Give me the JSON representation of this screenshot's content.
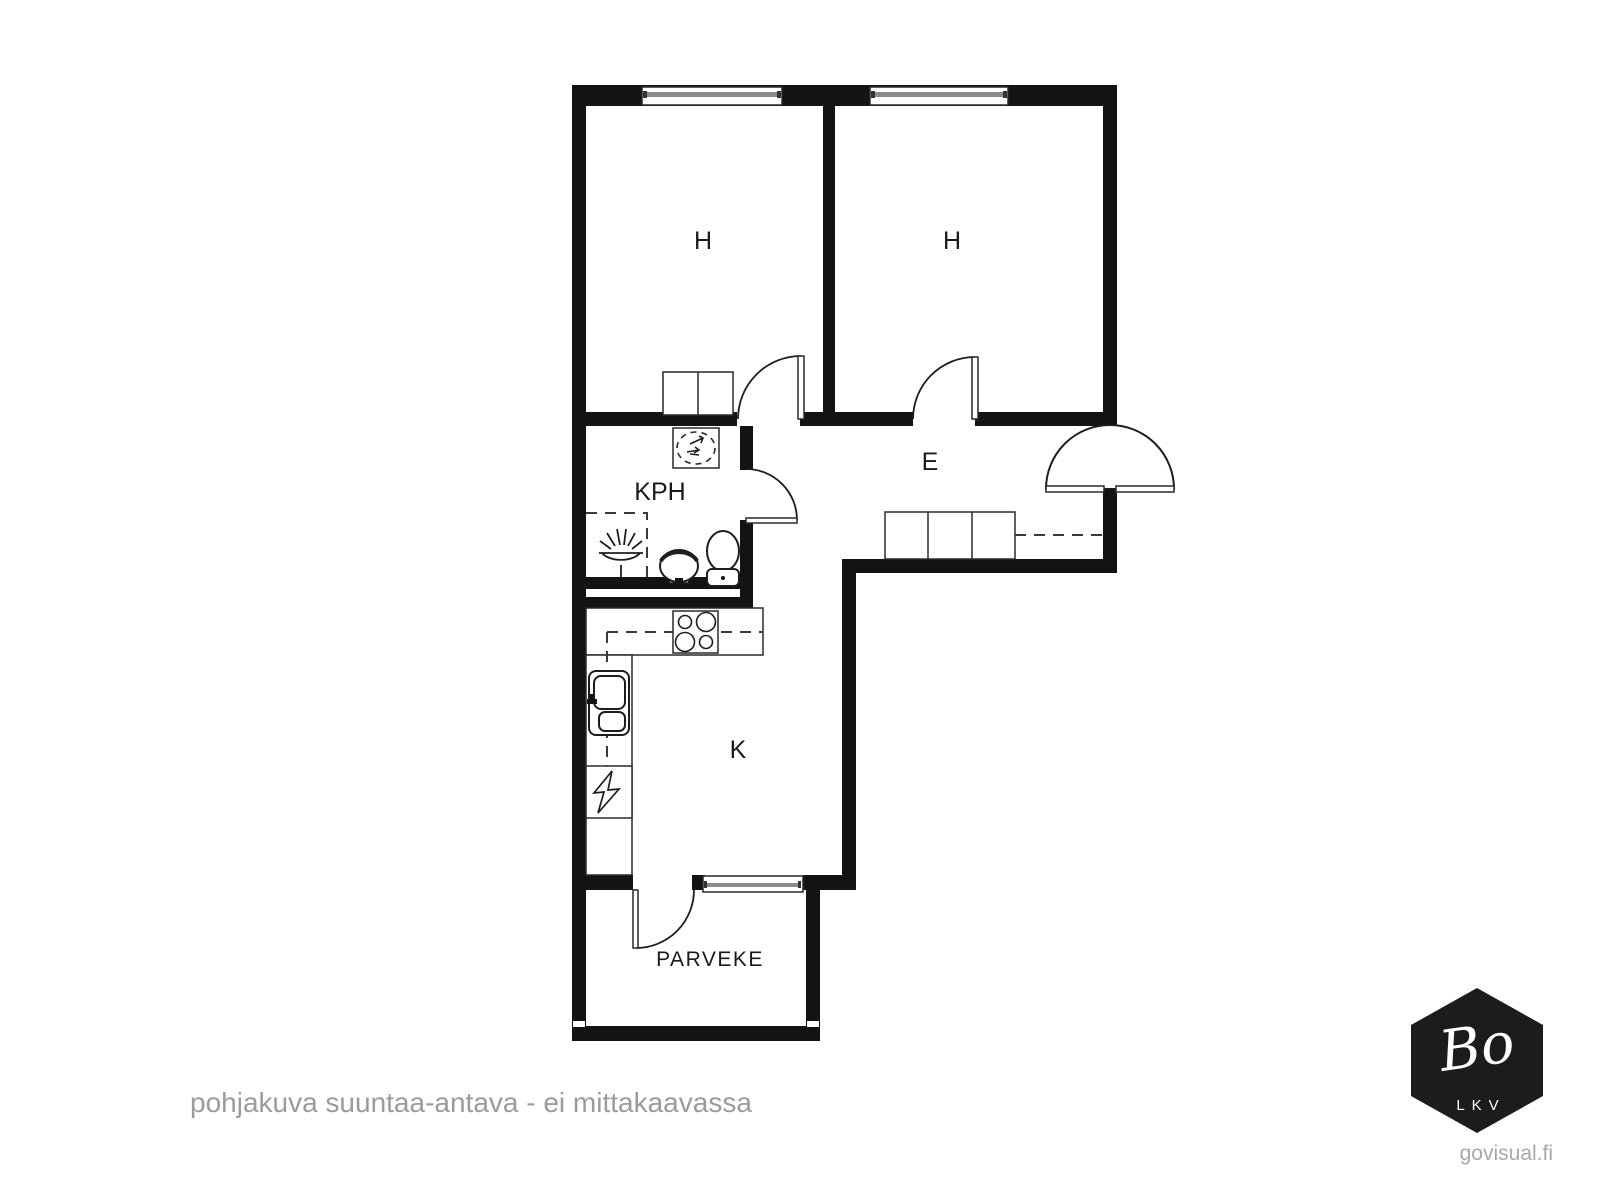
{
  "rooms": {
    "bedroom_left": "H",
    "bedroom_right": "H",
    "bathroom": "KPH",
    "hallway": "E",
    "kitchen": "K",
    "balcony": "PARVEKE"
  },
  "footer": {
    "disclaimer": "pohjakuva suuntaa-antava - ei mittakaavassa",
    "watermark": "govisual.fi"
  },
  "logo": {
    "brand": "Bo",
    "subtitle": "LKV"
  },
  "colors": {
    "wall": "#131313",
    "stroke": "#1d1d1d",
    "window_bar": "#8a8a8a",
    "muted_text": "#9b9b9b",
    "watermark_text": "#a8a8a8",
    "logo_bg": "#1c1c1c"
  }
}
